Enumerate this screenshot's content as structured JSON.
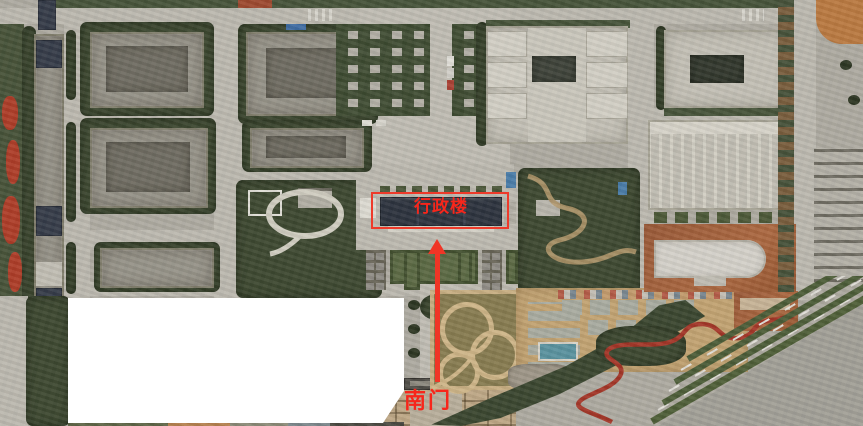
{
  "scene": {
    "type": "aerial-campus-photograph",
    "labels": {
      "admin_building": "行政楼",
      "south_gate": "南门"
    },
    "annotation_text_color": "#f7261b",
    "highlight_box_color": "#ee3a2a",
    "arrow_color": "#f03526",
    "mask_color": "#ffffff"
  }
}
